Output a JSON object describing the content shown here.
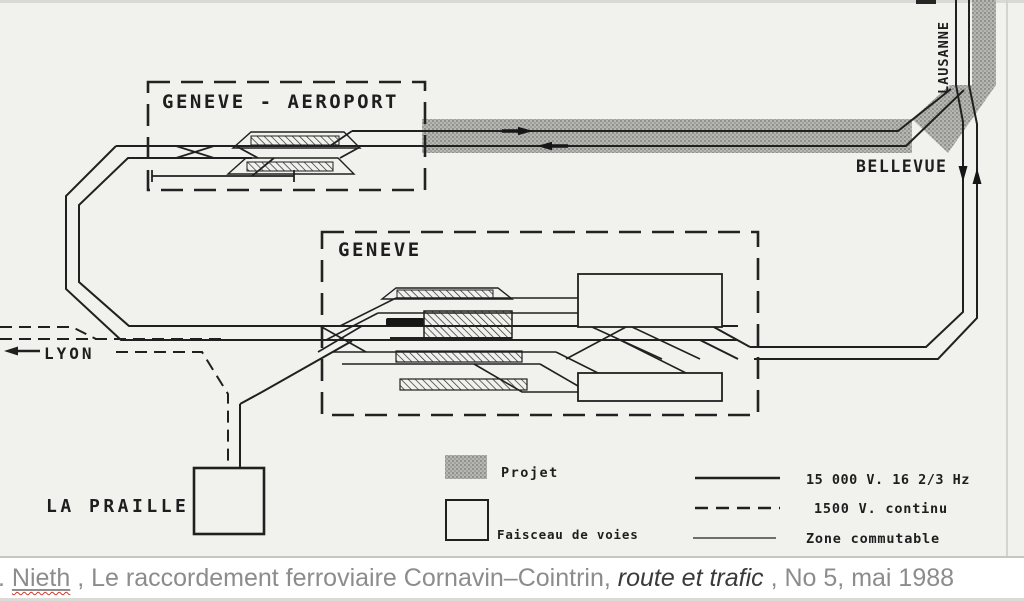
{
  "figure": {
    "labels": {
      "airport": "GENEVE - AEROPORT",
      "geneva": "GENEVE",
      "bellevue": "BELLEVUE",
      "lausanne": "LAUSANNE",
      "lyon": "LYON",
      "la_praille": "LA PRAILLE"
    },
    "legend": {
      "projet": "Projet",
      "faisceau": "Faisceau de voies",
      "line_15000": "15 000 V. 16 2/3 Hz",
      "line_1500": "1500 V. continu",
      "line_zone": "Zone commutable"
    },
    "colors": {
      "paper": "#f1f2ed",
      "ink": "#1f1f1f",
      "band_gray": "#afafac"
    }
  },
  "caption": {
    "lead": ".",
    "author": "Nieth",
    "middle": ", Le raccordement ferroviaire Cornavin–Cointrin, ",
    "italic": "route et trafic",
    "tail": ", No 5, mai 1988"
  }
}
